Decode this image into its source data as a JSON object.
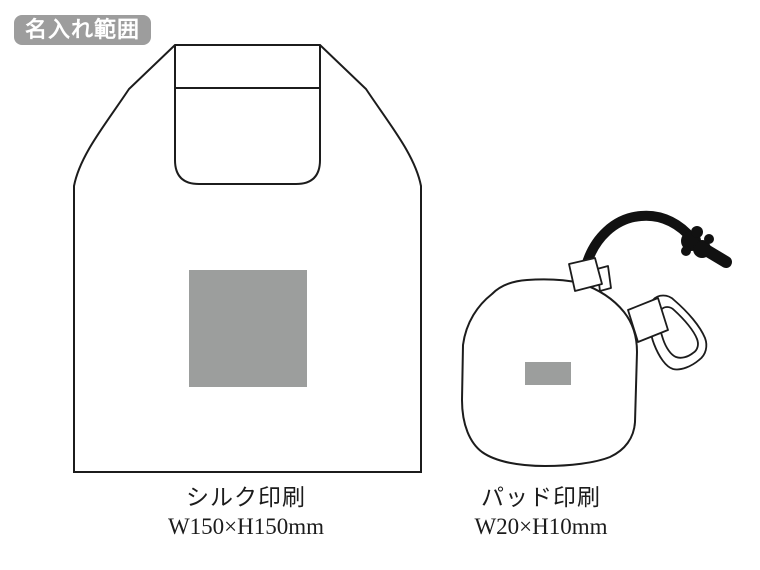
{
  "badge": {
    "label": "名入れ範囲"
  },
  "colors": {
    "background": "#ffffff",
    "outline": "#1c1c1c",
    "badge_bg": "#9d9d9d",
    "badge_text": "#ffffff",
    "print_area_fill": "#9c9e9d",
    "cord": "#111111"
  },
  "items": [
    {
      "id": "tote-bag",
      "print_method": "シルク印刷",
      "print_size": "W150×H150mm"
    },
    {
      "id": "folded-pouch",
      "print_method": "パッド印刷",
      "print_size": "W20×H10mm"
    }
  ]
}
